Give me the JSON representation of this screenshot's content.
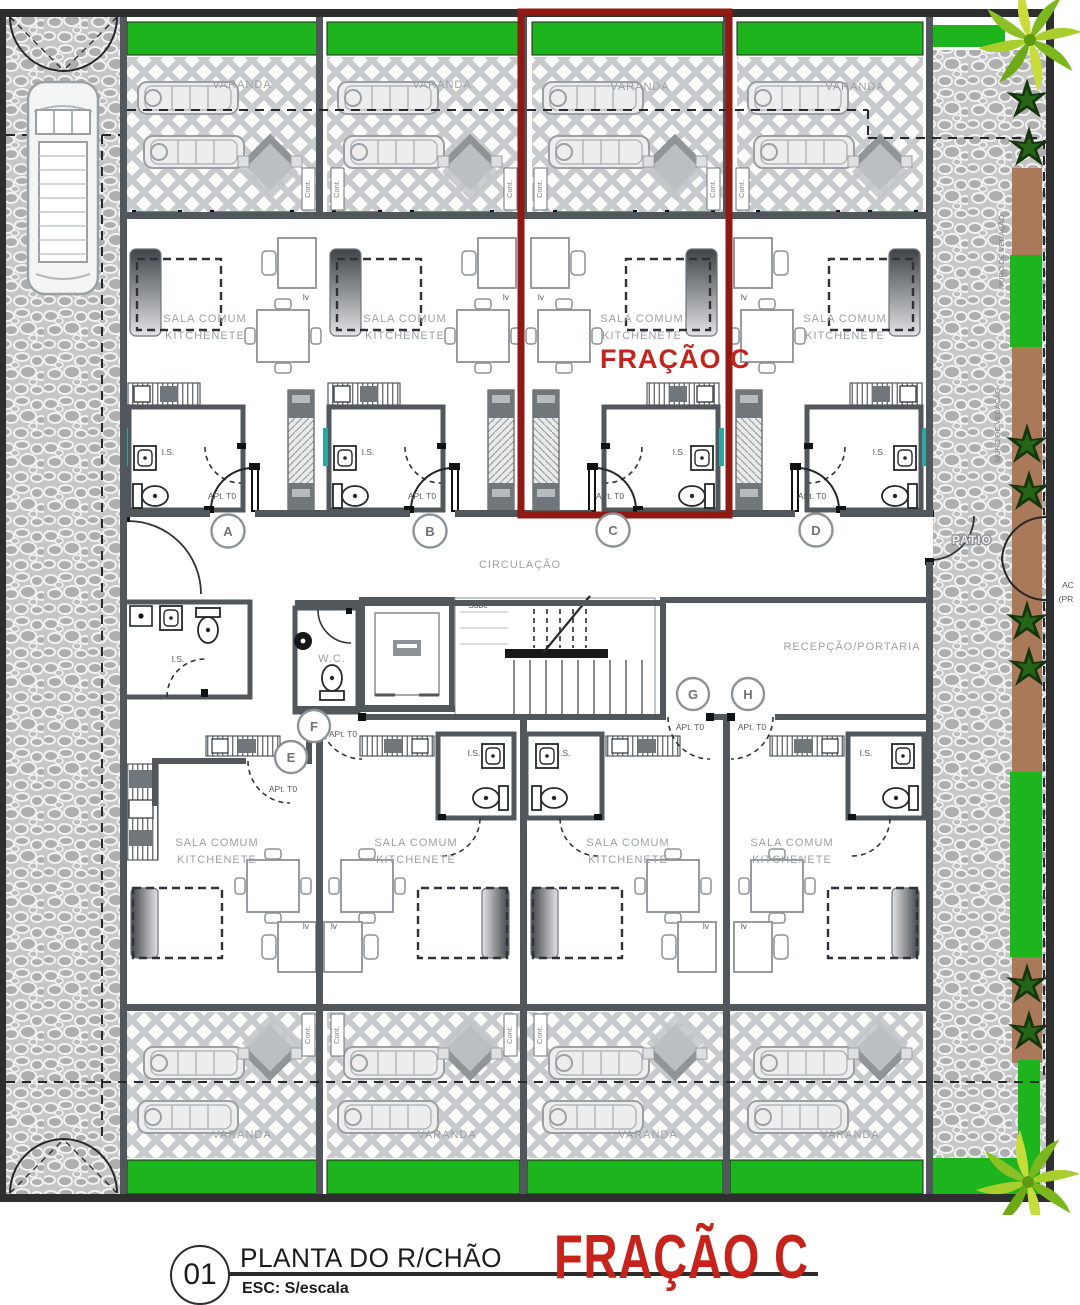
{
  "labels": {
    "varanda": "VARANDA",
    "sala1": "SALA COMUM",
    "sala2": "KITCHENETE",
    "is": "I.S.",
    "wc": "W.C.",
    "apt": "APt. T0",
    "circulacao": "CIRCULAÇÃO",
    "recepcao": "RECEPÇÃO/PORTARIA",
    "patio": "PATIO",
    "sube": "Sube",
    "cont": "Cont.",
    "lv": "lv",
    "fracao": "FRAÇÃO C",
    "muro": "MURO DE VEDAÇÃO",
    "ac": "AC",
    "pr": "(PR"
  },
  "markers": [
    "A",
    "B",
    "C",
    "D",
    "E",
    "F",
    "G",
    "H"
  ],
  "title_block": {
    "number": "01",
    "title": "PLANTA DO R/CHÃO",
    "scale": "ESC: S/escala",
    "fraction": "FRAÇÃO C"
  },
  "colors": {
    "green": "#1db41d",
    "teal": "#2aa79e",
    "red_outline": "#8f1a14",
    "red_text": "#c3241c",
    "wall": "#52575b",
    "brown": "#a9795a"
  }
}
